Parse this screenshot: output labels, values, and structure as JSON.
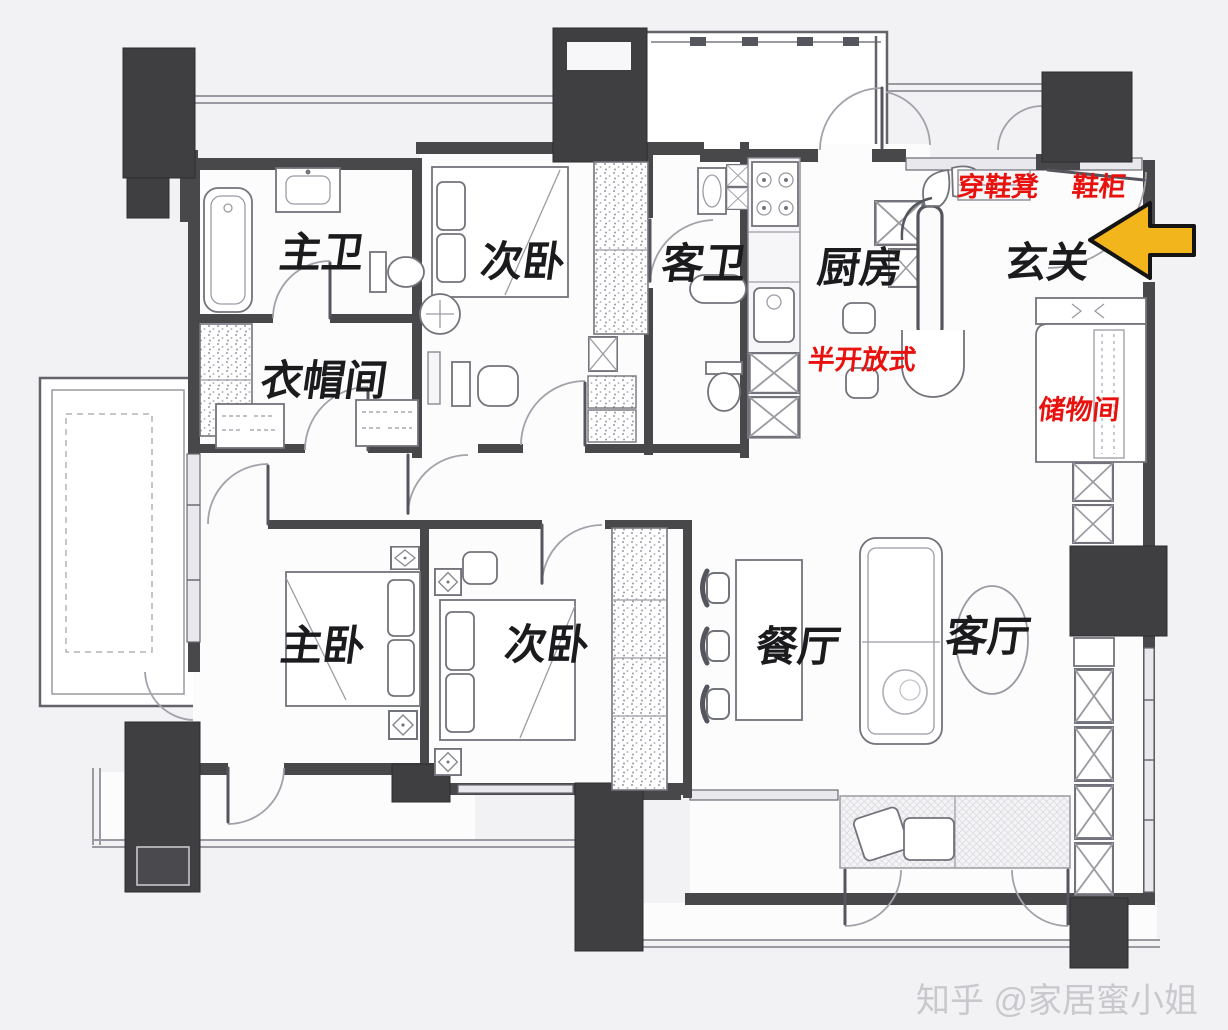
{
  "title": "apartment-floor-plan",
  "colors": {
    "bg": "#f2f2f4",
    "wall": "#48484b",
    "pillar": "#3f3f42",
    "red": "#e8110d",
    "yellow": "#f2b61c",
    "watermark": "#c7c7cb"
  },
  "rooms": [
    {
      "id": "master-bath",
      "label": "主卫"
    },
    {
      "id": "bedroom2-top",
      "label": "次卧"
    },
    {
      "id": "guest-bath",
      "label": "客卫"
    },
    {
      "id": "kitchen",
      "label": "厨房"
    },
    {
      "id": "entry",
      "label": "玄关"
    },
    {
      "id": "cloakroom",
      "label": "衣帽间"
    },
    {
      "id": "master-bedroom",
      "label": "主卧"
    },
    {
      "id": "bedroom2-bottom",
      "label": "次卧"
    },
    {
      "id": "dining-room",
      "label": "餐厅"
    },
    {
      "id": "living-room",
      "label": "客厅"
    }
  ],
  "annotations": [
    {
      "id": "shoe-bench",
      "label": "穿鞋凳"
    },
    {
      "id": "shoe-cabinet",
      "label": "鞋柜"
    },
    {
      "id": "semi-open",
      "label": "半开放式"
    },
    {
      "id": "storage-room",
      "label": "储物间"
    }
  ],
  "entry_arrow": {
    "icon": "left-arrow-icon",
    "color": "#f2b61c"
  },
  "watermark": {
    "label": "知乎 @家居蜜小姐"
  }
}
